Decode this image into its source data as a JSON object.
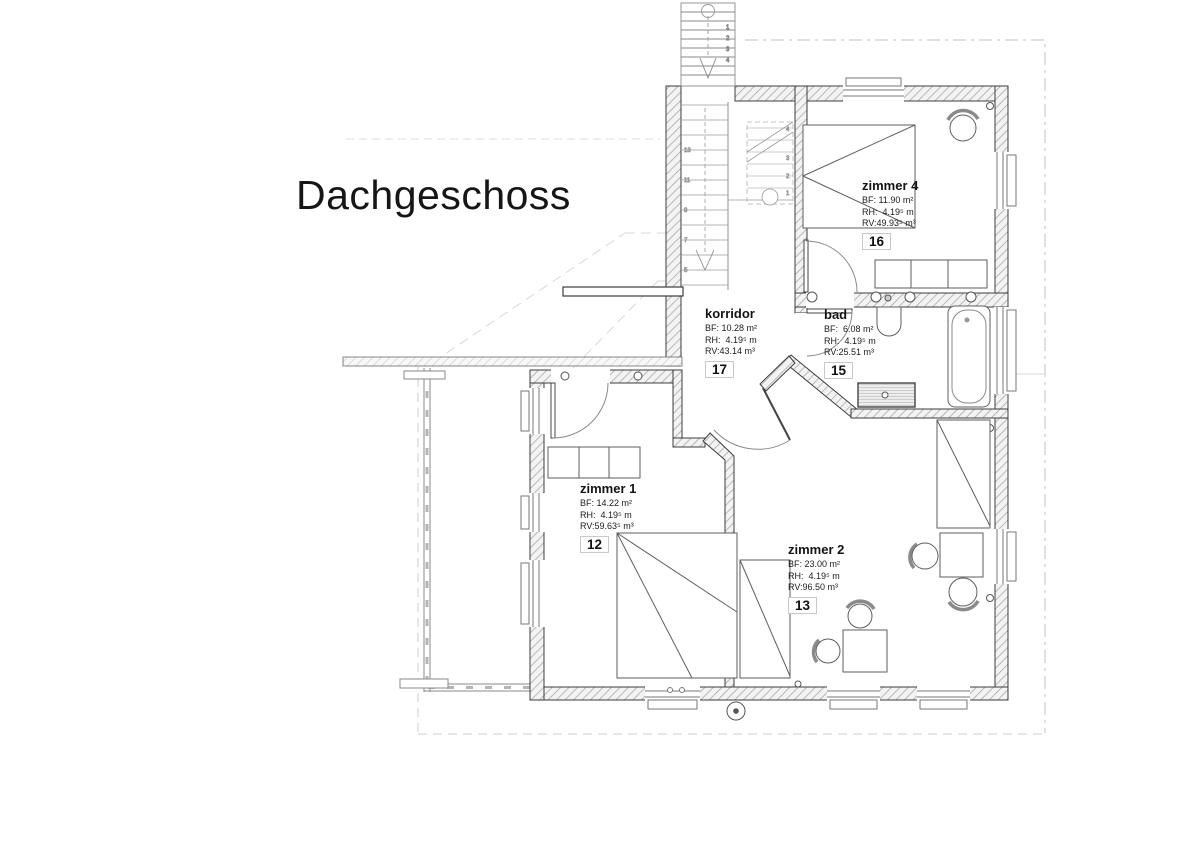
{
  "title": "Dachgeschoss",
  "rooms": {
    "zimmer4": {
      "name": "zimmer 4",
      "bf": "BF: 11.90 m²",
      "rh": "RH:  4.19⁵ m",
      "rv": "RV:49.93⁵ m³",
      "nr": "16"
    },
    "korridor": {
      "name": "korridor",
      "bf": "BF: 10.28 m²",
      "rh": "RH:  4.19⁵ m",
      "rv": "RV:43.14 m³",
      "nr": "17"
    },
    "bad": {
      "name": "bad",
      "bf": "BF:  6.08 m²",
      "rh": "RH:  4.19⁵ m",
      "rv": "RV:25.51 m³",
      "nr": "15"
    },
    "zimmer1": {
      "name": "zimmer 1",
      "bf": "BF: 14.22 m²",
      "rh": "RH:  4.19⁵ m",
      "rv": "RV:59.63⁵ m³",
      "nr": "12"
    },
    "zimmer2": {
      "name": "zimmer 2",
      "bf": "BF: 23.00 m²",
      "rh": "RH:  4.19⁵ m",
      "rv": "RV:96.50 m³",
      "nr": "13"
    }
  },
  "stairs": {
    "exterior": [
      "1",
      "2",
      "3",
      "4"
    ],
    "interior_upper": [
      "1",
      "2",
      "3",
      "4"
    ],
    "interior_lower": [
      "5",
      "7",
      "9",
      "11",
      "13"
    ]
  },
  "colors": {
    "wall_outline": "#3c3c3c",
    "hatch": "#a9a9a9",
    "faint_dash": "#d6d6d6",
    "text": "#141414"
  }
}
